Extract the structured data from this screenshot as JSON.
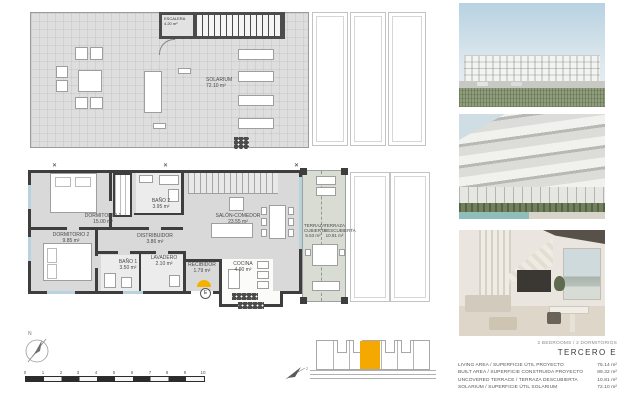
{
  "colors": {
    "accent_orange": "#f5a800",
    "wall_dark": "#3e3e3e",
    "window_blue": "#b9d3de"
  },
  "solarium": {
    "escalera_name": "ESCALERA",
    "escalera_area": "4.20 m²",
    "solarium_name": "SOLARIUM",
    "solarium_area": "72.10 m²"
  },
  "main": {
    "rooms": {
      "dormitorio1": {
        "name": "DORMITORIO 1",
        "area": "15.00 m²"
      },
      "dormitorio2": {
        "name": "DORMITORIO 2",
        "area": "9.85 m²"
      },
      "bano2": {
        "name": "BAÑO 2",
        "area": "3.95 m²"
      },
      "distribuidor": {
        "name": "DISTRIBUIDOR",
        "area": "3.86 m²"
      },
      "bano1": {
        "name": "BAÑO 1",
        "area": "3.50 m²"
      },
      "lavadero": {
        "name": "LAVADERO",
        "area": "2.10 m²"
      },
      "recibidor": {
        "name": "RECIBIDOR",
        "area": "1.79 m²"
      },
      "salon": {
        "name": "SALÓN-COMEDOR",
        "area": "23.55 m²"
      },
      "cocina": {
        "name": "COCINA",
        "area": "4.90 m²"
      },
      "terraza_cubierta": {
        "name": "TERRAZA CUBIERTA",
        "area": "5.53 m²"
      },
      "terraza_descubierta": {
        "name": "TERRAZA DESCUBIERTA",
        "area": "10.81 m²"
      }
    },
    "entrance_badge": "E"
  },
  "compass": {
    "north": "N"
  },
  "keyplan": {
    "compass_label": "z"
  },
  "scale": {
    "ticks": [
      "0",
      "1",
      "2",
      "3",
      "4",
      "5",
      "6",
      "7",
      "8",
      "9",
      "10"
    ]
  },
  "legend": {
    "bedrooms": "2 BEDROOMS / 2 DORMITORIOS",
    "title": "TERCERO  E",
    "rows": [
      {
        "label": "LIVING AREA / SUPERFICIE ÚTIL PROYECTO",
        "value": "75.14 m²"
      },
      {
        "label": "BUILT AREA / SUPERFICIE CONSTRUIDA PROYECTO",
        "value": "89.32 m²"
      },
      {
        "label": "UNCOVERED TERRACE / TERRAZA DESCUBIERTA",
        "value": "10.81 m²"
      },
      {
        "label": "SOLARIUM / SUPERFICIE ÚTIL SOLARIUM",
        "value": "72.10 m²"
      }
    ]
  }
}
